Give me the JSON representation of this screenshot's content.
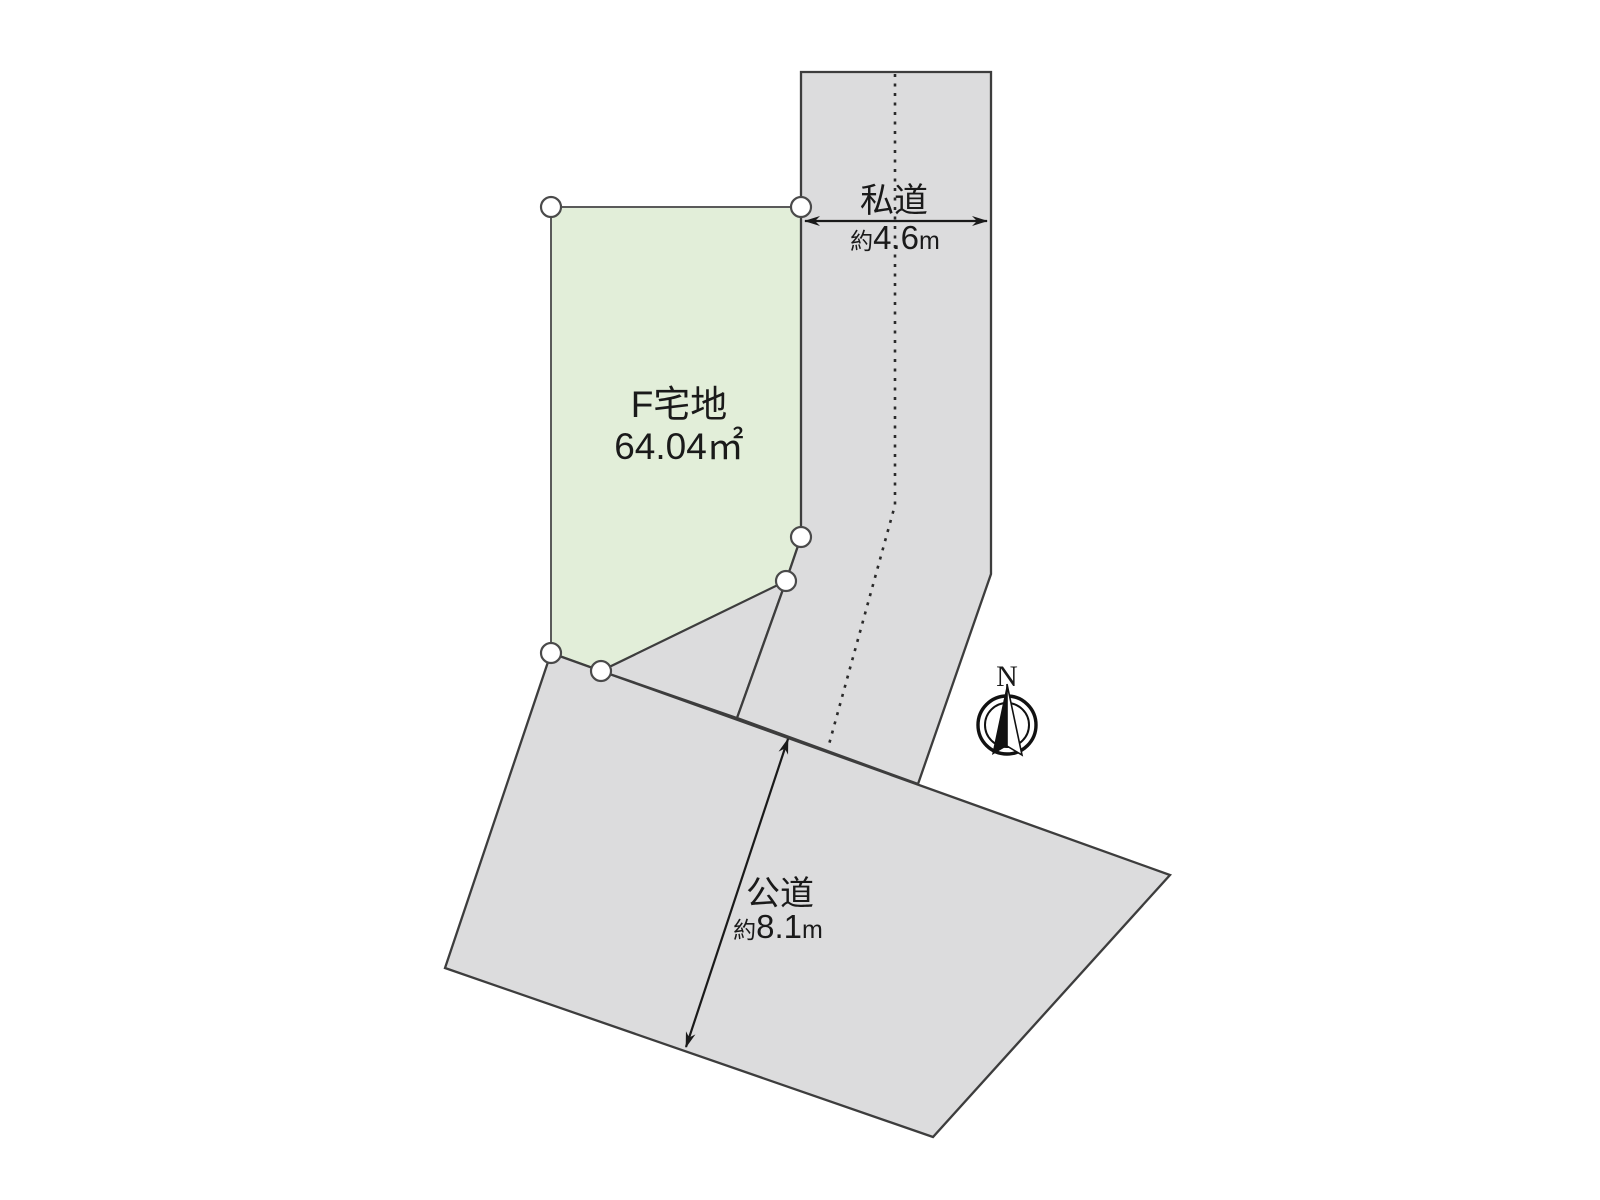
{
  "diagram": {
    "plot": {
      "name": "F宅地",
      "area": "64.04㎡"
    },
    "private_road": {
      "name": "私道",
      "width_prefix": "約",
      "width_value": "4.6",
      "width_unit": "m"
    },
    "public_road": {
      "name": "公道",
      "width_prefix": "約",
      "width_value": "8.1",
      "width_unit": "m"
    },
    "compass": {
      "north_label": "N",
      "icon": "compass-north-icon"
    },
    "survey_points": {
      "count": 6,
      "icon": "survey-point-circle-icon"
    },
    "colors": {
      "background": "#ffffff",
      "plot_fill": "#e2eed9",
      "plot_stroke": "#5a5a5a",
      "road_fill": "#dcdcdd",
      "road_stroke": "#3d3d3d",
      "dimension_line": "#1a1a1a",
      "centerline": "#2a2a2a",
      "text": "#1a1a1a",
      "survey_point_fill": "#ffffff",
      "survey_point_stroke": "#4a4a4a",
      "compass_ink": "#111111"
    }
  }
}
